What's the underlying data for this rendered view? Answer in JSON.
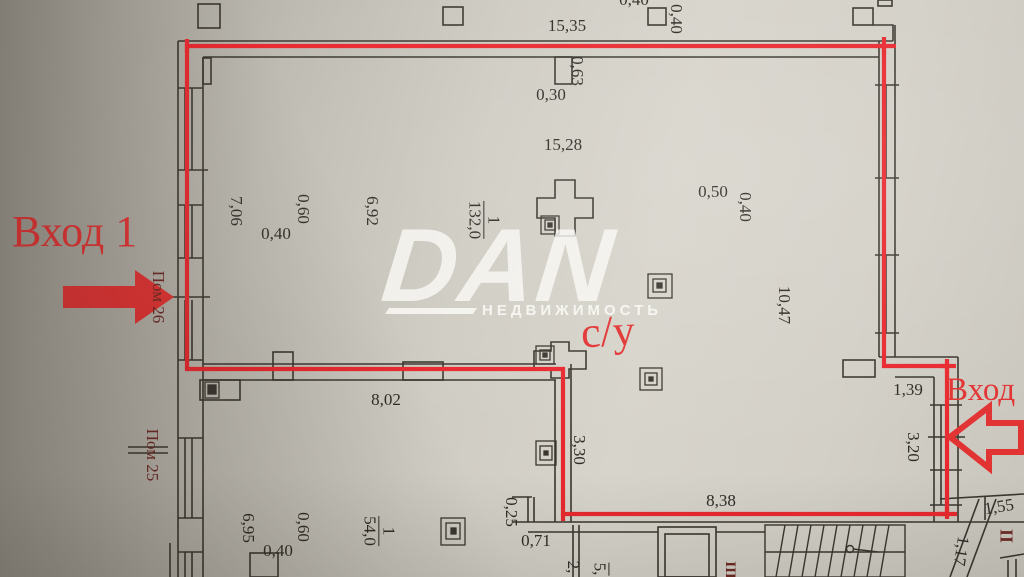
{
  "photo": {
    "watermark": {
      "logo": "DAN",
      "subtitle": "НЕДВИЖИМОСТЬ"
    },
    "annotations": {
      "entrance1": "Вход 1",
      "entrance2": "Вход 2",
      "bathroom": "с/у",
      "premise26": "Пом 26",
      "premise25": "Пом 25",
      "stairwell2": "II",
      "stairwell3": "III"
    },
    "rooms": {
      "main": {
        "number": "1",
        "area": "132,0"
      },
      "lower": {
        "number": "1",
        "area": "54,0"
      }
    },
    "dims": {
      "top_outer": "15,35",
      "top_col_w": "0,40",
      "top_col_h": "0,40",
      "top_inner": "15,28",
      "pilaster_h": "0,63",
      "pilaster_w": "0,30",
      "left_room_w": "7,06",
      "col1_w": "0,60",
      "col1_h": "0,40",
      "mid_room_w": "6,92",
      "col2_w": "0,50",
      "col2_h": "0,40",
      "right_depth": "10,47",
      "jog_w": "1,39",
      "shop_window": "3,20",
      "lower_room_w": "8,02",
      "inner_depth": "3,30",
      "bottom_w": "8,38",
      "notch_a": "0,25",
      "notch_b": "0,71",
      "lower_left_w": "6,95",
      "col3_w": "0,60",
      "col3_h": "0,40",
      "lobby_w": "1,55",
      "lobby_d": "1,17",
      "part_a": "2,",
      "part_b": "5,"
    },
    "colors": {
      "accent_red": "#e23333",
      "dark_red": "#6e2823",
      "ink": "#2f2b26",
      "paper": "#d5d2c9"
    }
  }
}
